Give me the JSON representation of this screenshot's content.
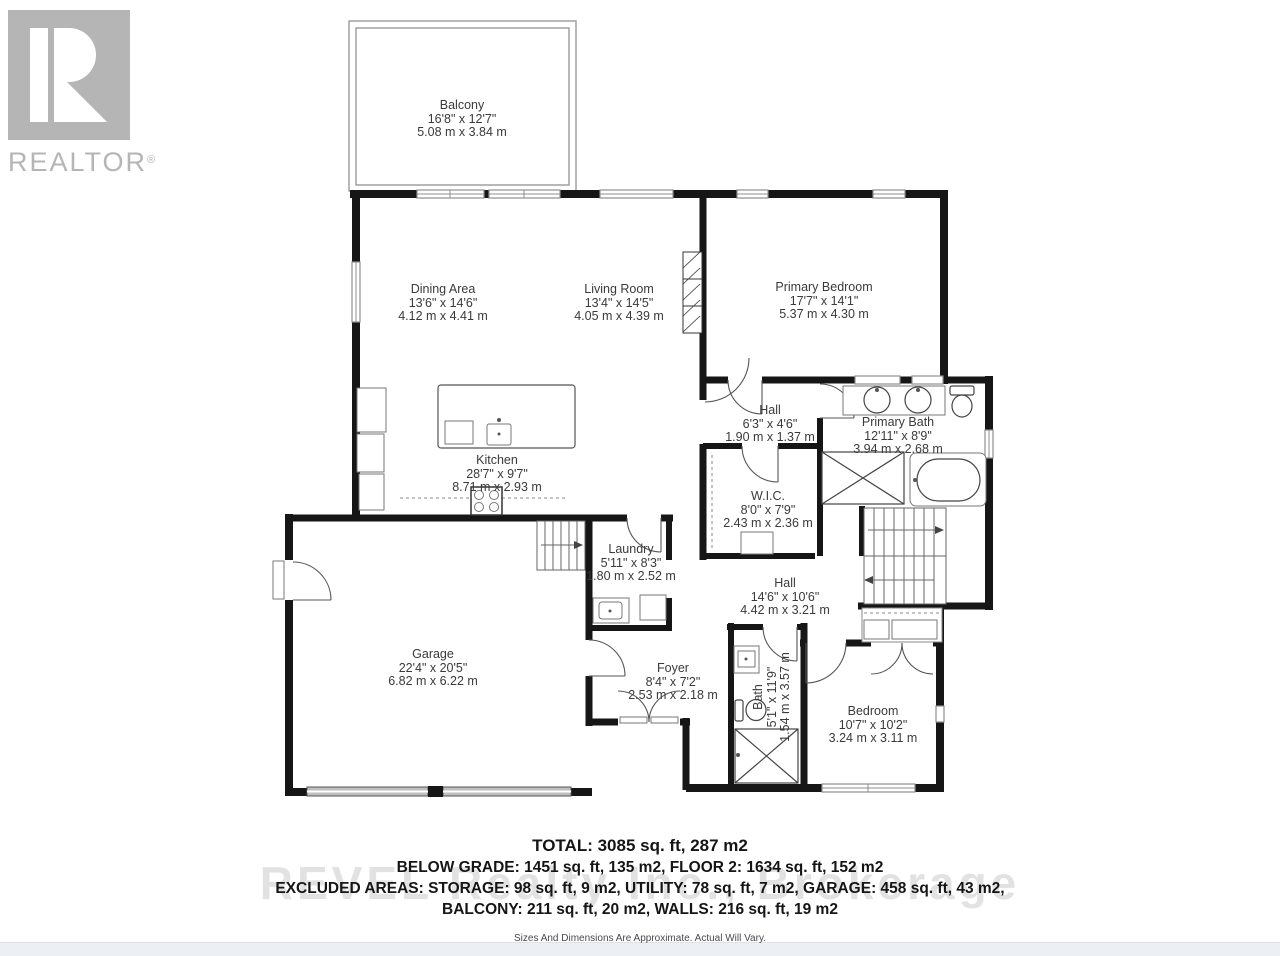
{
  "logo": {
    "brand": "REALTOR",
    "registered": "®"
  },
  "rooms": [
    {
      "name": "Balcony",
      "dim_ft": "16'8\" x 12'7\"",
      "dim_m": "5.08 m x 3.84 m"
    },
    {
      "name": "Dining Area",
      "dim_ft": "13'6\" x 14'6\"",
      "dim_m": "4.12 m x 4.41 m"
    },
    {
      "name": "Living Room",
      "dim_ft": "13'4\" x 14'5\"",
      "dim_m": "4.05 m x 4.39 m"
    },
    {
      "name": "Primary Bedroom",
      "dim_ft": "17'7\" x 14'1\"",
      "dim_m": "5.37 m x 4.30 m"
    },
    {
      "name": "Kitchen",
      "dim_ft": "28'7\" x 9'7\"",
      "dim_m": "8.71 m x 2.93 m"
    },
    {
      "name": "Hall",
      "dim_ft": "6'3\" x 4'6\"",
      "dim_m": "1.90 m x 1.37 m"
    },
    {
      "name": "Primary Bath",
      "dim_ft": "12'11\" x 8'9\"",
      "dim_m": "3.94 m x 2.68 m"
    },
    {
      "name": "W.I.C.",
      "dim_ft": "8'0\" x 7'9\"",
      "dim_m": "2.43 m x 2.36 m"
    },
    {
      "name": "Laundry",
      "dim_ft": "5'11\" x 8'3\"",
      "dim_m": "1.80 m x 2.52 m"
    },
    {
      "name": "Hall",
      "dim_ft": "14'6\" x 10'6\"",
      "dim_m": "4.42 m x 3.21 m"
    },
    {
      "name": "Garage",
      "dim_ft": "22'4\" x 20'5\"",
      "dim_m": "6.82 m x 6.22 m"
    },
    {
      "name": "Foyer",
      "dim_ft": "8'4\" x 7'2\"",
      "dim_m": "2.53 m x 2.18 m"
    },
    {
      "name": "Bath",
      "dim_ft": "5'1\" x 11'9\"",
      "dim_m": "1.54 m x 3.57 m"
    },
    {
      "name": "Bedroom",
      "dim_ft": "10'7\" x 10'2\"",
      "dim_m": "3.24 m x 3.11 m"
    }
  ],
  "summary": {
    "total": "TOTAL: 3085 sq. ft, 287 m2",
    "line2": "BELOW GRADE: 1451 sq. ft, 135 m2, FLOOR 2: 1634 sq. ft, 152 m2",
    "line3": "EXCLUDED AREAS: STORAGE: 98 sq. ft, 9 m2, UTILITY: 78 sq. ft, 7 m2, GARAGE: 458 sq. ft, 43 m2,",
    "line4": "BALCONY: 211 sq. ft, 20 m2, WALLS: 216 sq. ft, 19 m2",
    "disclaimer": "Sizes And Dimensions Are Approximate. Actual Will Vary."
  },
  "watermark": "REVEL Realty Inc., Brokerage",
  "colors": {
    "wall": "#161616",
    "logo_gray": "#b5b5b5",
    "window_frame": "#8f8f8f",
    "strip": "#eceff3"
  }
}
